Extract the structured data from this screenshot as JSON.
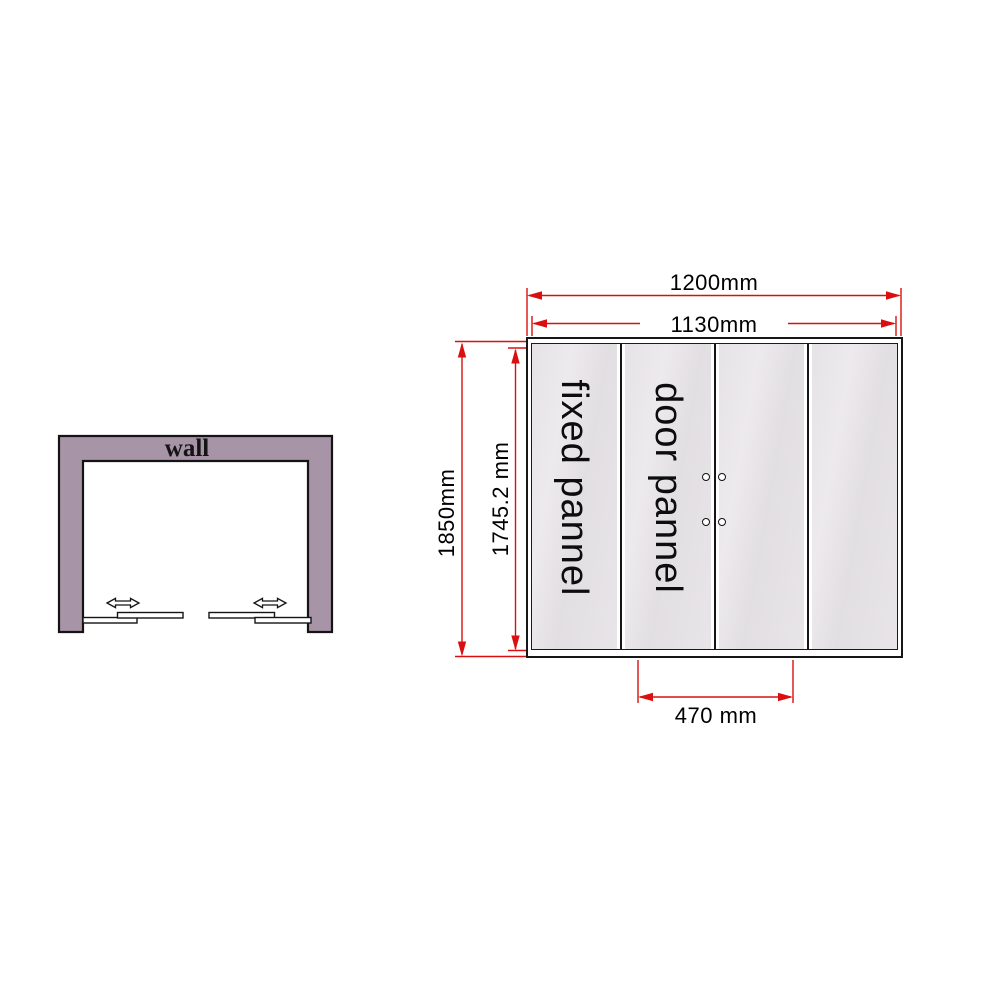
{
  "view": {
    "background": "#ffffff"
  },
  "top_view": {
    "title": "wall",
    "wall_color": "#a894a7"
  },
  "front_view": {
    "fixed_panel_label": "fixed pannel",
    "door_panel_label": "door pannel",
    "dim_outer_width": "1200mm",
    "dim_inner_width": "1130mm",
    "dim_total_height": "1850mm",
    "dim_glass_height": "1745.2 mm",
    "dim_door_width": "470 mm",
    "dimension_color": "#da1010",
    "glass_color": "#e5e2e5",
    "panel_count": 4,
    "handle_count": 4
  }
}
